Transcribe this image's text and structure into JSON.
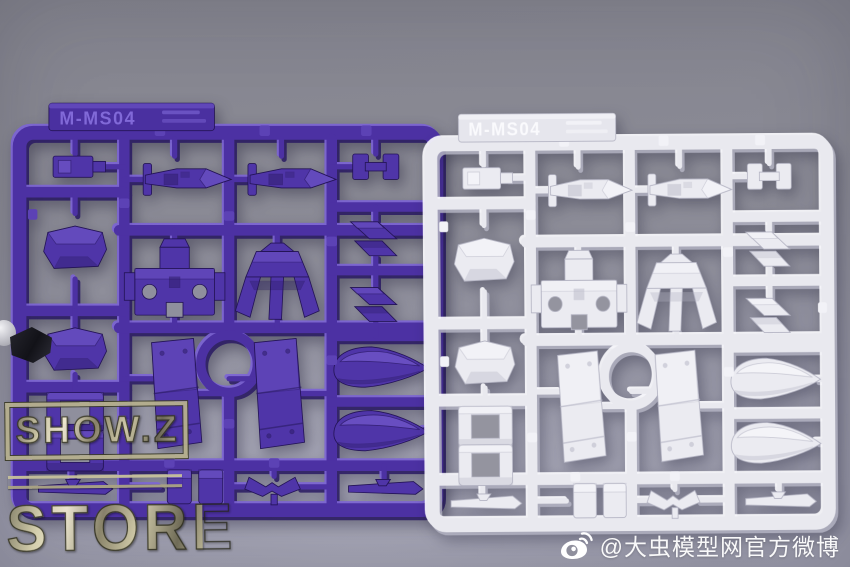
{
  "background": {
    "top_color": "#84848e",
    "bottom_color": "#9c9cac"
  },
  "sprues": {
    "purple": {
      "tab_label": "M-MS04",
      "plastic_color": "#4a2f9e"
    },
    "white": {
      "tab_label": "M-MS04",
      "plastic_color": "#e9e9ef"
    }
  },
  "watermarks": {
    "store_badge": {
      "line1": "SHOW.Z",
      "line2": "STORE",
      "metal_color": "#cfc9a2"
    },
    "weibo": {
      "handle": "@大虫模型网官方微博",
      "icon": "weibo-logo",
      "text_color": "#ffffff"
    }
  }
}
